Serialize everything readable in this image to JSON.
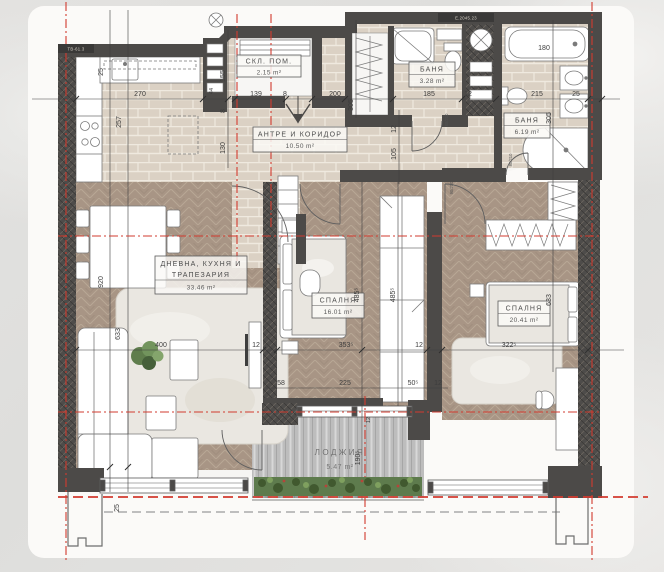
{
  "title": "apartment-floor-plan",
  "colors": {
    "wall": "#4c4a48",
    "axis_red": "#d23b2f",
    "tile_floor": "#dbd1c4",
    "wood_floor": "#a89585",
    "deck_floor": "#bdbdbd",
    "sheet": "#fbfaf8"
  },
  "rooms": {
    "storage": {
      "name": "СКЛ. ПОМ.",
      "area": "2.15 m²"
    },
    "hall": {
      "name": "АНТРЕ И КОРИДОР",
      "area": "10.50 m²"
    },
    "bath1": {
      "name": "БАНЯ",
      "area": "3.28 m²"
    },
    "bath2": {
      "name": "БАНЯ",
      "area": "6.19 m²"
    },
    "living": {
      "name_line1": "ДНЕВНА, КУХНЯ И",
      "name_line2": "ТРАПЕЗАРИЯ",
      "area": "33.46 m²"
    },
    "bedroom1": {
      "name": "СПАЛНЯ",
      "area": "16.01 m²"
    },
    "bedroom2": {
      "name": "СПАЛНЯ",
      "area": "20.41 m²"
    },
    "loggia": {
      "name": "ЛОДЖИЯ",
      "area": "5.47 m²"
    }
  },
  "dims": {
    "d270": "270",
    "d139": "139",
    "d8a": "8",
    "d200": "200",
    "d185": "185",
    "d12a": "12",
    "d215": "215",
    "d25a": "25",
    "d44": "44",
    "d25b": "25",
    "d257": "257",
    "d920": "920",
    "d633a": "633",
    "d155": "155",
    "d8b": "8",
    "d130": "130",
    "d305a": "305",
    "d12b": "12",
    "d105": "105",
    "d305b": "305",
    "d4855a": "485⁵",
    "d4855b": "485⁵",
    "d633b": "633",
    "d400": "400",
    "d12c": "12",
    "d3535": "353⁵",
    "d12d": "12",
    "d3225": "322⁵",
    "d58": "58",
    "d225": "225",
    "d505": "50⁵",
    "d12e": "12",
    "d12f": "12",
    "d1905": "190⁵",
    "d25c": "25",
    "d180": "180"
  },
  "door_tags": {
    "t1": "80/210",
    "t2": "80/210",
    "t3": "90/210"
  },
  "wall_tags": {
    "left": "ТВ-61.3",
    "top": "Е.2045.23"
  }
}
